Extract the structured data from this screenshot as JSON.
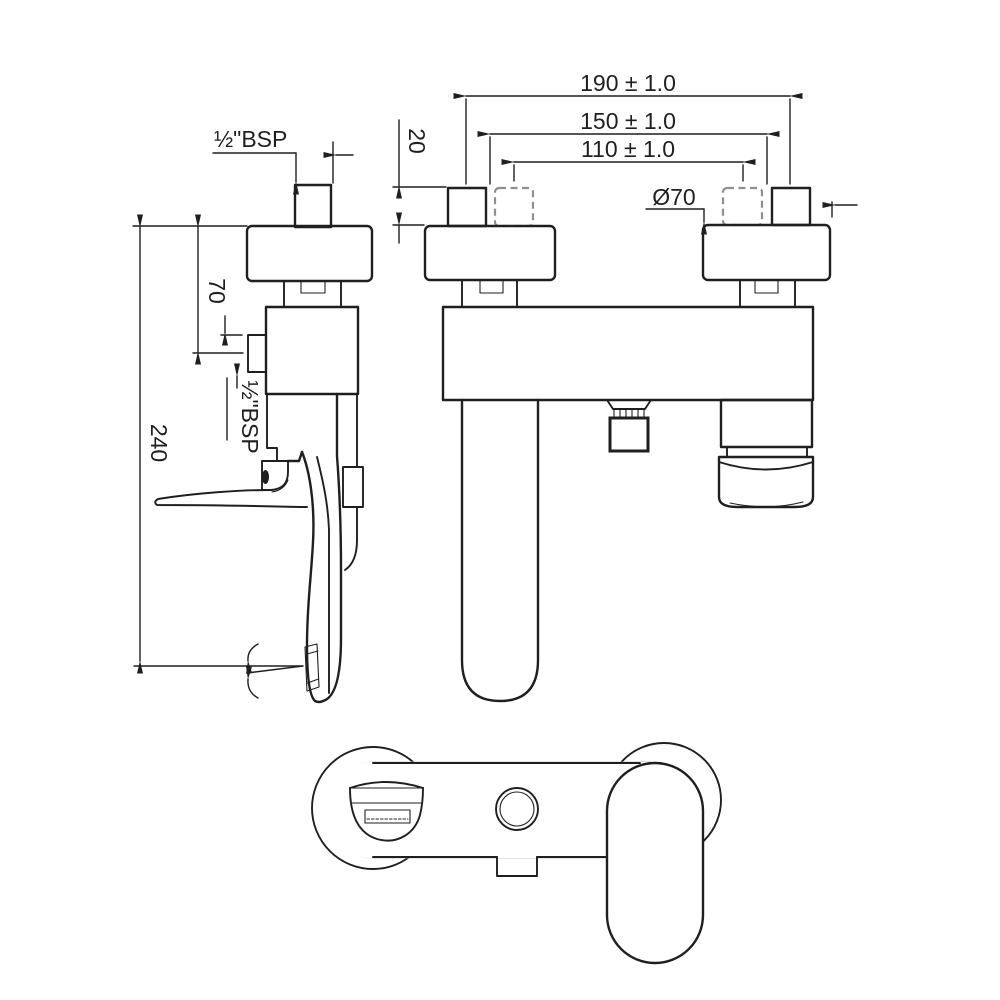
{
  "drawing": {
    "type": "bath-shower mixer installation drawing, three orthographic views",
    "colors": {
      "line": "#1f1f1f",
      "hidden_line": "#8f8f8f",
      "background": "#ffffff"
    },
    "dims": {
      "d190": "190 ± 1.0",
      "d150": "150 ± 1.0",
      "d110": "110 ± 1.0",
      "d20": "20",
      "dia70": "Ø70",
      "bsp_top": "½\"BSP",
      "d70": "70",
      "d240": "240",
      "bsp_side": "½\"BSP"
    }
  }
}
